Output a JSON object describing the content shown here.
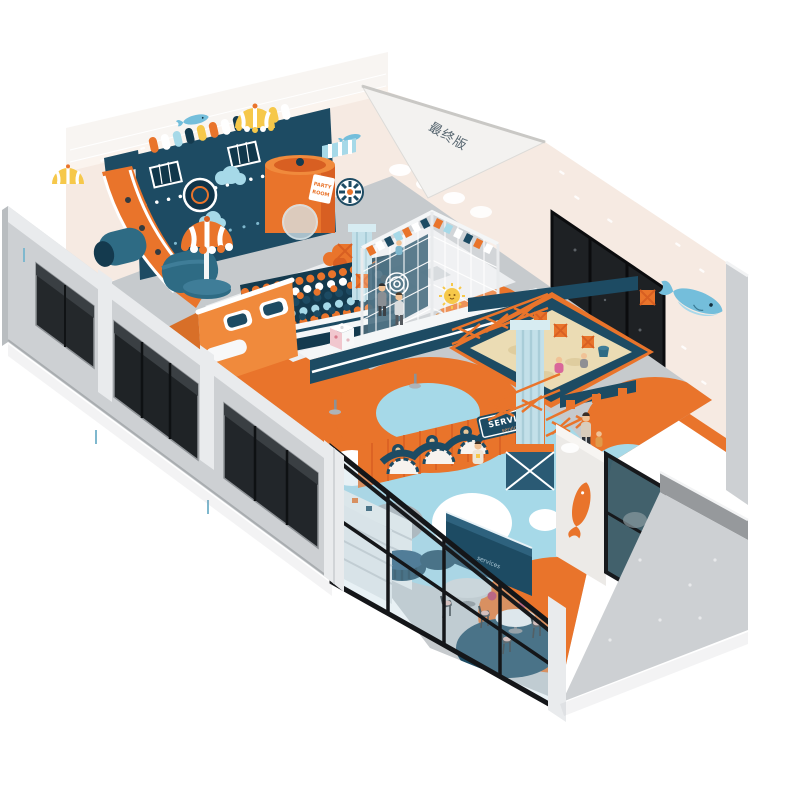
{
  "labels": {
    "roof_version": "最终版",
    "party_room_line1": "PARTY",
    "party_room_line2": "ROOM",
    "service_sign": "SERVICE",
    "service_sign_small": "service",
    "reception_desk": "services"
  },
  "palette": {
    "orange": "#E9742B",
    "orangeDeep": "#D85F22",
    "navy": "#1D4B63",
    "navyDark": "#143A4E",
    "teal": "#2E6B84",
    "lightblue": "#A6D9E8",
    "paleBlue": "#C3E0E9",
    "cream": "#F6EAE2",
    "sand": "#EBDCB4",
    "grayWall": "#CDD0D3",
    "grayEdge": "#E9EBED",
    "grayDark": "#96999C",
    "floorGray": "#C6CACD",
    "glassTint": "#B4D2DE",
    "frameBlack": "#141619",
    "windowDark": "#1E2124",
    "yellow": "#F6C84A",
    "pink": "#F1C7CE",
    "whaleBlue": "#74BEDB",
    "skin": "#F0C296"
  }
}
